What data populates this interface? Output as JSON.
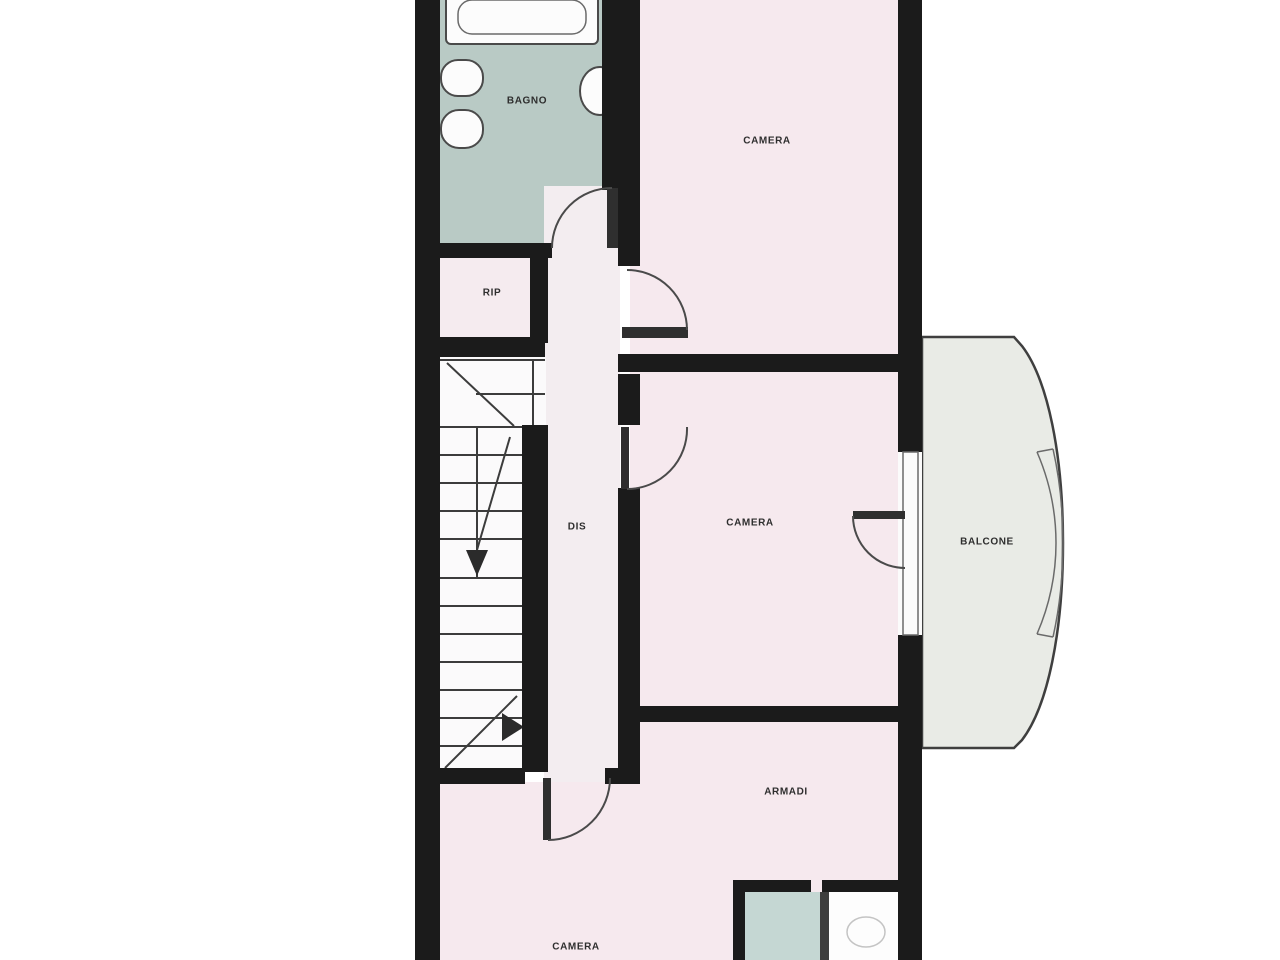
{
  "plan_type": "floor-plan",
  "language": "Italian",
  "rooms": {
    "bagno": {
      "label": "BAGNO"
    },
    "camera_top": {
      "label": "CAMERA"
    },
    "rip": {
      "label": "RIP"
    },
    "dis": {
      "label": "DIS"
    },
    "camera_middle": {
      "label": "CAMERA"
    },
    "balcone": {
      "label": "BALCONE"
    },
    "armadi": {
      "label": "ARMADI"
    },
    "camera_bottom": {
      "label": "CAMERA"
    }
  },
  "fixtures": [
    "bathtub",
    "washbasin",
    "washbasin",
    "toilet",
    "staircase",
    "door-swing",
    "french-window",
    "balcony-railing"
  ],
  "colors": {
    "wall": "#1b1b1b",
    "bagno_floor": "#b9cac5",
    "bedroom_floor": "#f6e9ee",
    "corridor_floor": "#f3edf0",
    "rip_floor": "#f5ebef",
    "balcony_floor": "#e9ebe6",
    "small_bath_floor": "#c5d7d3",
    "stairwell_floor": "#fbfafb",
    "background": "#ffffff",
    "line": "#3c3c3c",
    "label_text": "#2e2e2e"
  }
}
